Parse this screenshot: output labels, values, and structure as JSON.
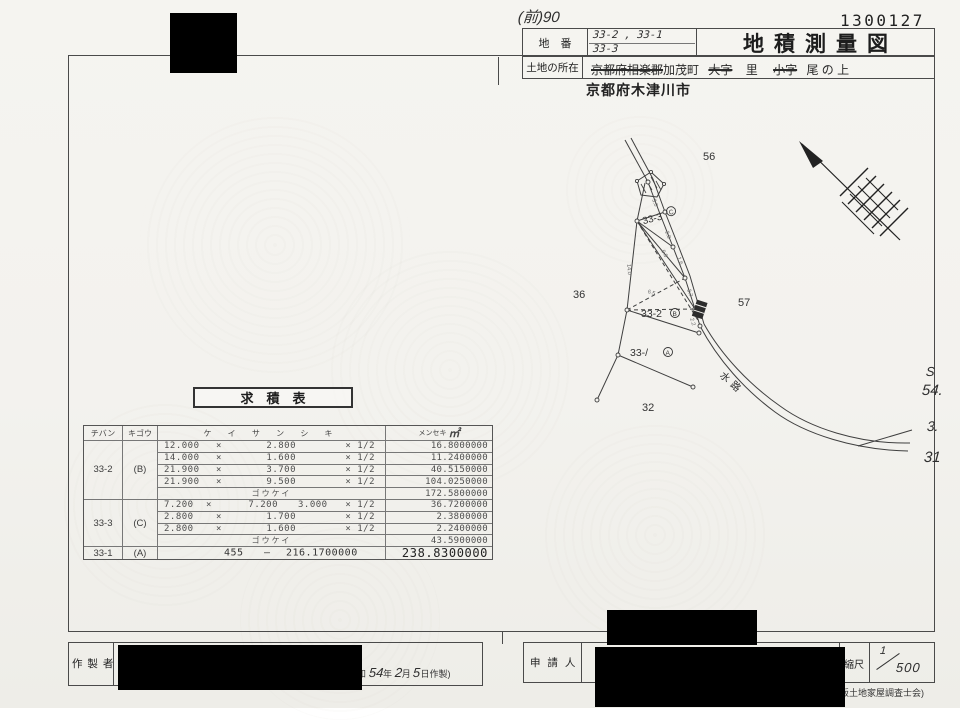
{
  "page": {
    "handwritten_ref": "(前)90",
    "doc_number": "1300127",
    "title": "地積測量図",
    "header": {
      "lot_label": "地　番",
      "lot_line1": "33-2 , 33-1",
      "lot_line2": "33-3",
      "location_label": "土地の所在",
      "loc_struck_pref": "京都府相楽郡",
      "loc_town": "加茂町",
      "loc_struck_oaza": "大字",
      "loc_sato": "里",
      "loc_struck_koaza": "小字",
      "loc_rest": "尾 の 上",
      "city_stamp": "京都府木津川市"
    },
    "side_note": {
      "l1": "S",
      "l2": "54.",
      "l3": "3.",
      "l4": "31"
    },
    "credit": "(大阪土地家屋調査士会)"
  },
  "map": {
    "label_56": "56",
    "label_36": "36",
    "label_57": "57",
    "label_32": "32",
    "parcel_33_3": "33-3",
    "mark_c": "C",
    "parcel_33_2": "33-2",
    "mark_b": "B",
    "parcel_33_1": "33-/",
    "mark_a": "A",
    "waterway": "水路",
    "measurements": [
      "3.0",
      "2.8",
      "1.6",
      "3.7",
      "9.5",
      "6.5",
      "2.2",
      "14.0"
    ]
  },
  "table": {
    "title": "求　積　表",
    "headers": {
      "lot": "チバン",
      "symbol": "キゴウ",
      "formula": "ケ イ サ ン シ キ",
      "area": "メンセキ",
      "unit": "㎡"
    },
    "subtotal_label": "ゴウケイ",
    "g1": {
      "lot": "33-2",
      "symbol": "(B)",
      "r1": {
        "a": "12.000",
        "x": "×",
        "b": "2.800",
        "h": "× 1/2",
        "v": "16.8000000"
      },
      "r2": {
        "a": "14.000",
        "x": "×",
        "b": "1.600",
        "h": "× 1/2",
        "v": "11.2400000"
      },
      "r3": {
        "a": "21.900",
        "x": "×",
        "b": "3.700",
        "h": "× 1/2",
        "v": "40.5150000"
      },
      "r4": {
        "a": "21.900",
        "x": "×",
        "b": "9.500",
        "h": "× 1/2",
        "v": "104.0250000"
      },
      "subtotal": "172.5800000"
    },
    "g2": {
      "lot": "33-3",
      "symbol": "(C)",
      "r1": {
        "a": "7.200",
        "x": "×",
        "b": "7.200",
        "c": "3.000",
        "h": "× 1/2",
        "v": "36.7200000"
      },
      "r2": {
        "a": "2.800",
        "x": "×",
        "b": "1.700",
        "h": "× 1/2",
        "v": "2.3800000"
      },
      "r3": {
        "a": "2.800",
        "x": "×",
        "b": "1.600",
        "h": "× 1/2",
        "v": "2.2400000"
      },
      "subtotal": "43.5900000"
    },
    "g3": {
      "lot": "33-1",
      "symbol": "(A)",
      "base": "455",
      "dash": "—",
      "deduction": "216.1700000",
      "v": "238.8300000"
    }
  },
  "footer": {
    "maker_label": "作 製 者",
    "date_prefix": "和",
    "date_year": "54",
    "date_y_unit": "年",
    "date_month": "2",
    "date_m_unit": "月",
    "date_day": "5",
    "date_d_unit": "日作製)",
    "applicant_label": "申 請 人",
    "scale_label": "縮尺",
    "scale_num": "1",
    "scale_den": "500"
  }
}
